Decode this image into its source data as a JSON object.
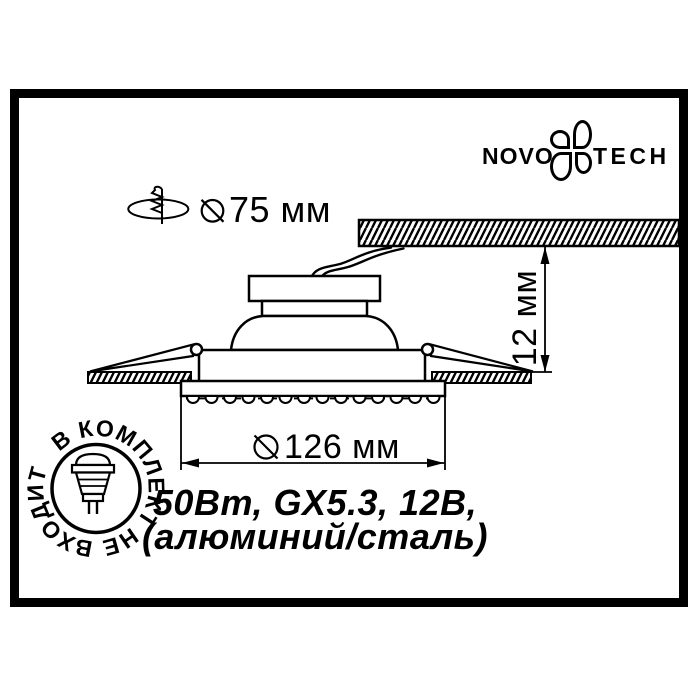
{
  "brand": {
    "name_left": "NOVO",
    "name_right": "TECH"
  },
  "labels": {
    "cutout_diameter": "75 мм",
    "visible_diameter": "126 мм",
    "depth": "12 мм",
    "spec_line1": "50Вт, GX5.3, 12В,",
    "spec_line2": "(алюминий/сталь)",
    "stamp_text": "В КОМПЛЕКТ НЕ ВХОДИТ"
  },
  "colors": {
    "ink": "#000000",
    "paper": "#ffffff"
  }
}
